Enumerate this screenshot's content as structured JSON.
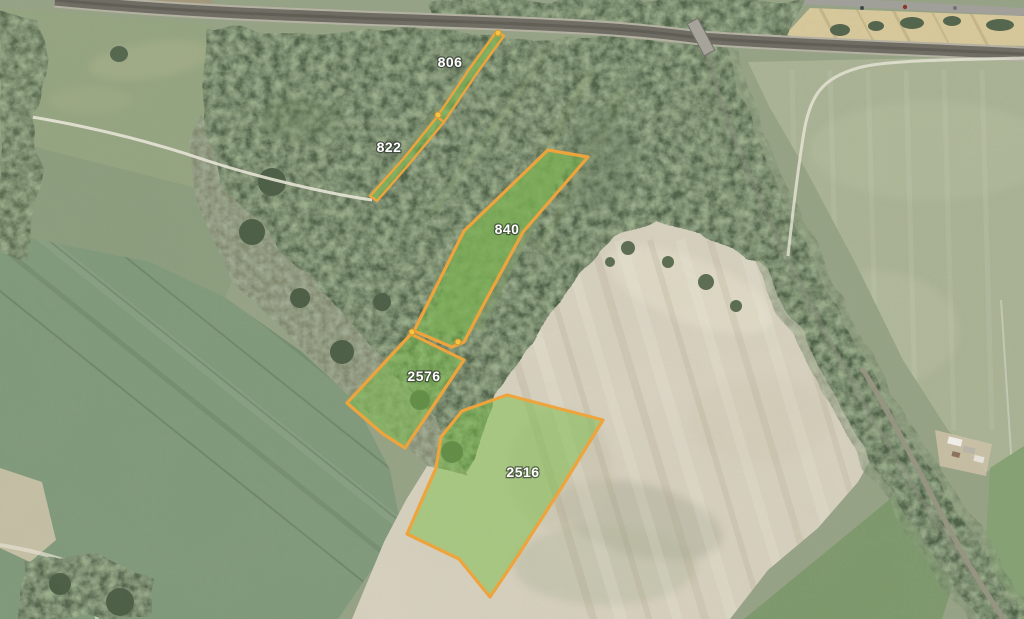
{
  "map": {
    "description": "aerial-imagery-with-cadastral-parcel-overlay",
    "colors": {
      "parcel_stroke": "#eea43c",
      "parcel_fill": "rgba(122,190,72,0.5)",
      "node_fill": "#f6c445",
      "label_color": "#ffffff"
    },
    "parcels": [
      {
        "id": "806",
        "label": "806",
        "label_x": 450,
        "label_y": 67,
        "thin": true,
        "points": [
          [
            497,
            31
          ],
          [
            504,
            36
          ],
          [
            477,
            73
          ],
          [
            444,
            122
          ],
          [
            437,
            117
          ],
          [
            470,
            68
          ]
        ]
      },
      {
        "id": "822",
        "label": "822",
        "label_x": 389,
        "label_y": 152,
        "thin": true,
        "points": [
          [
            437,
            117
          ],
          [
            444,
            122
          ],
          [
            410,
            163
          ],
          [
            377,
            201
          ],
          [
            370,
            196
          ],
          [
            404,
            158
          ]
        ]
      },
      {
        "id": "840",
        "label": "840",
        "label_x": 507,
        "label_y": 234,
        "thin": false,
        "points": [
          [
            548,
            150
          ],
          [
            588,
            157
          ],
          [
            523,
            232
          ],
          [
            486,
            300
          ],
          [
            464,
            342
          ],
          [
            452,
            347
          ],
          [
            414,
            331
          ],
          [
            464,
            231
          ]
        ]
      },
      {
        "id": "2576",
        "label": "2576",
        "label_x": 424,
        "label_y": 381,
        "thin": false,
        "points": [
          [
            411,
            334
          ],
          [
            464,
            360
          ],
          [
            405,
            448
          ],
          [
            383,
            434
          ],
          [
            347,
            403
          ]
        ]
      },
      {
        "id": "2516",
        "label": "2516",
        "label_x": 523,
        "label_y": 477,
        "thin": false,
        "points": [
          [
            507,
            395
          ],
          [
            603,
            420
          ],
          [
            560,
            490
          ],
          [
            517,
            557
          ],
          [
            490,
            597
          ],
          [
            459,
            559
          ],
          [
            407,
            534
          ],
          [
            436,
            468
          ],
          [
            441,
            437
          ],
          [
            462,
            411
          ]
        ]
      }
    ],
    "nodes": [
      {
        "x": 498,
        "y": 33
      },
      {
        "x": 438,
        "y": 115
      },
      {
        "x": 412,
        "y": 332
      },
      {
        "x": 458,
        "y": 342
      }
    ]
  }
}
